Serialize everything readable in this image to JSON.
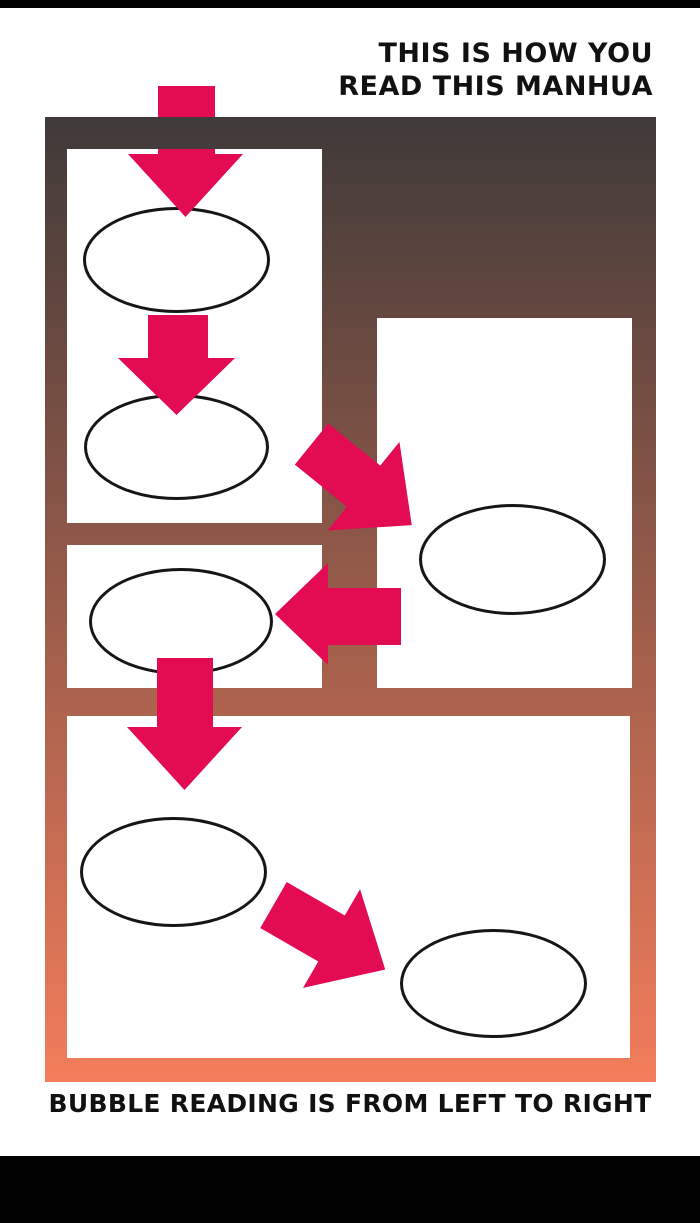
{
  "title": {
    "text": "THIS IS HOW YOU\nREAD THIS MANHUA"
  },
  "caption": {
    "text": "BUBBLE READING IS FROM LEFT TO RIGHT"
  },
  "colors": {
    "arrow": "#E30B52",
    "gradient_top": "#3F3A39",
    "gradient_bottom": "#F37D5B",
    "panel_bg": "#FFFFFF",
    "bubble_outline": "#161616",
    "bar": "#000000",
    "text": "#111111",
    "page_bg": "#FFFFFF"
  },
  "diagram": {
    "panel_count": 4,
    "bubble_count": 6,
    "reading_steps": [
      {
        "step": 1,
        "direction": "down",
        "meaning": "enter top-left panel"
      },
      {
        "step": 2,
        "direction": "down",
        "meaning": "next bubble below"
      },
      {
        "step": 3,
        "direction": "down-right",
        "meaning": "move to right panel"
      },
      {
        "step": 4,
        "direction": "left",
        "meaning": "back to left panel bubble"
      },
      {
        "step": 5,
        "direction": "down",
        "meaning": "down to bottom panel"
      },
      {
        "step": 6,
        "direction": "down-right",
        "meaning": "left bubble to right bubble"
      }
    ]
  }
}
